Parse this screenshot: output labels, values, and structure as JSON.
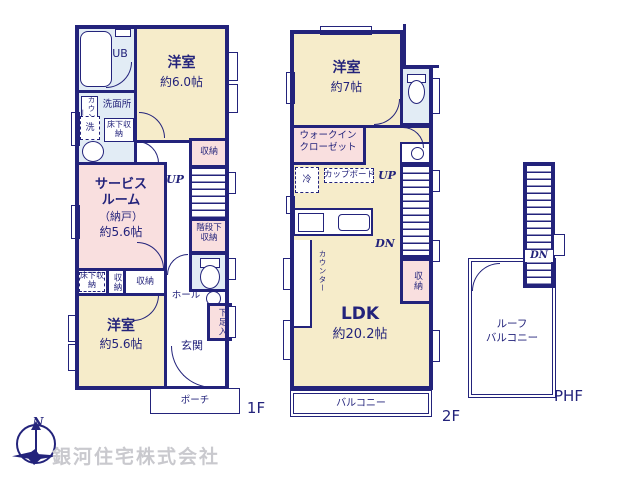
{
  "common": {
    "storage": "収納",
    "underfloor_storage": "床下収納",
    "up": "UP",
    "dn": "DN",
    "counter": "カウンター"
  },
  "floor1": {
    "floor_label": "1F",
    "unit_bath": "UB",
    "washroom": "洗面所",
    "washer": "洗",
    "western6": {
      "name": "洋室",
      "size": "約6.0帖"
    },
    "service": {
      "line1": "サービス",
      "line2": "ルーム",
      "line3": "（納戸）",
      "size": "約5.6帖"
    },
    "under_stairs": {
      "line1": "階段下",
      "line2": "収納"
    },
    "western56": {
      "name": "洋室",
      "size": "約5.6帖"
    },
    "hall": "ホール",
    "shoe_box": "下足入",
    "genkan": "玄関",
    "porch": "ポーチ"
  },
  "floor2": {
    "floor_label": "2F",
    "western7": {
      "name": "洋室",
      "size": "約7帖"
    },
    "wic": {
      "line1": "ウォークイン",
      "line2": "クローゼット"
    },
    "fridge": "冷",
    "cupboard": "カップボード",
    "ldk": {
      "name": "LDK",
      "size": "約20.2帖"
    },
    "balcony": "バルコニー"
  },
  "phf": {
    "floor_label": "PHF",
    "roof": {
      "line1": "ルーフ",
      "line2": "バルコニー"
    }
  },
  "compass": {
    "north": "N"
  },
  "watermark": "銀河住宅株式会社",
  "colors": {
    "wall": "#23237b",
    "room_cream": "#f6ecca",
    "room_pink": "#f9dfdf",
    "room_blue": "#e2ecf5",
    "watermark": "#c9c9ce"
  }
}
